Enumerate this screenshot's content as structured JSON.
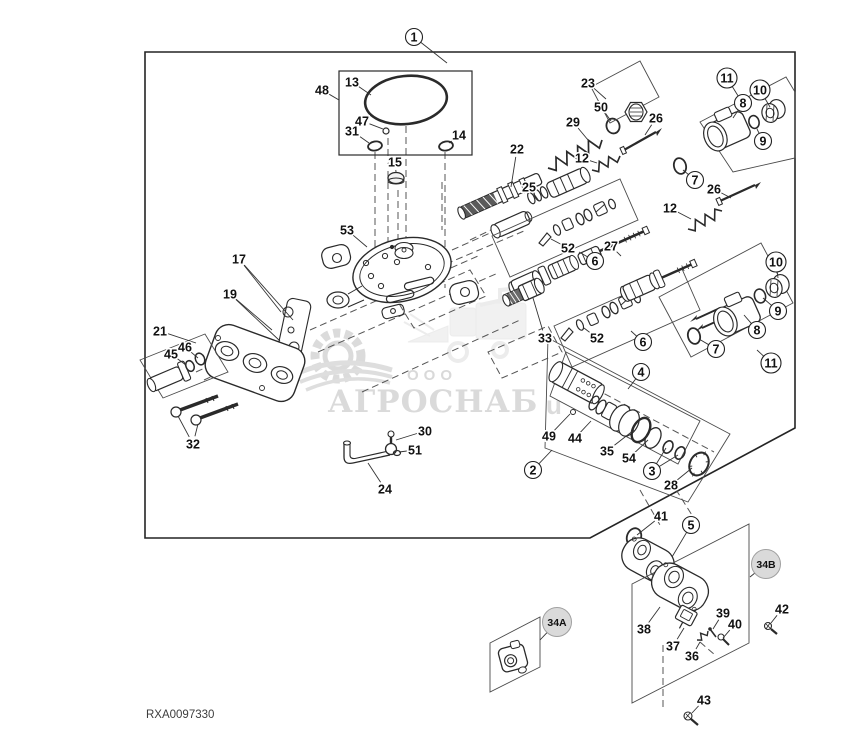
{
  "footer": {
    "part_number": "RXA0097330"
  },
  "watermark": {
    "prefix": "ООО",
    "company": "АГРОСНАБ",
    "fragment": "u",
    "color": "#c6c6c6"
  },
  "diagram": {
    "line_color": "#2a2a2a",
    "box_color": "#4a4a4a"
  },
  "callouts": [
    {
      "label": "1",
      "x": 414,
      "y": 37,
      "style": "circled",
      "leaders": [
        [
          447,
          63
        ]
      ]
    },
    {
      "label": "13",
      "x": 352,
      "y": 82,
      "style": "plain",
      "leaders": [
        [
          371,
          95
        ]
      ]
    },
    {
      "label": "48",
      "x": 322,
      "y": 90,
      "style": "plain",
      "leaders": [
        [
          339,
          100
        ]
      ]
    },
    {
      "label": "47",
      "x": 362,
      "y": 121,
      "style": "plain",
      "leaders": [
        [
          383,
          129
        ]
      ]
    },
    {
      "label": "31",
      "x": 352,
      "y": 131,
      "style": "plain",
      "leaders": [
        [
          369,
          143
        ]
      ]
    },
    {
      "label": "14",
      "x": 459,
      "y": 135,
      "style": "plain",
      "leaders": [
        [
          449,
          143
        ]
      ]
    },
    {
      "label": "15",
      "x": 395,
      "y": 162,
      "style": "plain",
      "leaders": [
        [
          396,
          172
        ]
      ]
    },
    {
      "label": "53",
      "x": 347,
      "y": 230,
      "style": "plain",
      "leaders": [
        [
          367,
          247
        ]
      ]
    },
    {
      "label": "17",
      "x": 239,
      "y": 259,
      "style": "plain",
      "leaders": [
        [
          281,
          312
        ],
        [
          293,
          320
        ]
      ]
    },
    {
      "label": "19",
      "x": 230,
      "y": 294,
      "style": "plain",
      "leaders": [
        [
          272,
          330
        ],
        [
          280,
          341
        ]
      ]
    },
    {
      "label": "21",
      "x": 160,
      "y": 331,
      "style": "plain",
      "leaders": [
        [
          196,
          343
        ]
      ]
    },
    {
      "label": "45",
      "x": 171,
      "y": 354,
      "style": "plain",
      "leaders": [
        [
          186,
          365
        ]
      ]
    },
    {
      "label": "46",
      "x": 185,
      "y": 347,
      "style": "plain",
      "leaders": [
        [
          198,
          358
        ]
      ]
    },
    {
      "label": "32",
      "x": 193,
      "y": 444,
      "style": "plain",
      "leaders": [
        [
          178,
          416
        ],
        [
          198,
          424
        ]
      ]
    },
    {
      "label": "30",
      "x": 425,
      "y": 431,
      "style": "plain",
      "leaders": [
        [
          396,
          440
        ]
      ]
    },
    {
      "label": "51",
      "x": 415,
      "y": 450,
      "style": "plain",
      "leaders": [
        [
          399,
          452
        ]
      ]
    },
    {
      "label": "24",
      "x": 385,
      "y": 489,
      "style": "plain",
      "leaders": [
        [
          368,
          463
        ]
      ]
    },
    {
      "label": "22",
      "x": 517,
      "y": 149,
      "style": "plain",
      "leaders": [
        [
          511,
          187
        ]
      ]
    },
    {
      "label": "29",
      "x": 573,
      "y": 122,
      "style": "plain",
      "leaders": [
        [
          588,
          140
        ]
      ]
    },
    {
      "label": "23",
      "x": 588,
      "y": 83,
      "style": "plain",
      "leaders": [
        [
          606,
          99
        ]
      ]
    },
    {
      "label": "50",
      "x": 601,
      "y": 107,
      "style": "plain",
      "leaders": [
        [
          611,
          121
        ]
      ]
    },
    {
      "label": "26",
      "x": 656,
      "y": 118,
      "style": "plain",
      "leaders": [
        [
          645,
          135
        ]
      ]
    },
    {
      "label": "12",
      "x": 582,
      "y": 158,
      "style": "plain",
      "leaders": [
        [
          597,
          163
        ]
      ]
    },
    {
      "label": "25",
      "x": 529,
      "y": 187,
      "style": "plain",
      "leaders": [
        [
          539,
          201
        ]
      ]
    },
    {
      "label": "27",
      "x": 611,
      "y": 246,
      "style": "plain",
      "leaders": [
        [
          621,
          256
        ]
      ]
    },
    {
      "label": "52",
      "x": 568,
      "y": 248,
      "style": "plain",
      "leaders": [
        [
          551,
          239
        ]
      ]
    },
    {
      "label": "6",
      "x": 595,
      "y": 261,
      "style": "circled",
      "leaders": [
        [
          579,
          252
        ]
      ]
    },
    {
      "label": "11",
      "x": 727,
      "y": 78,
      "style": "circled",
      "leaders": [
        [
          740,
          99
        ]
      ]
    },
    {
      "label": "10",
      "x": 760,
      "y": 90,
      "style": "circled",
      "leaders": [
        [
          770,
          107
        ]
      ]
    },
    {
      "label": "8",
      "x": 743,
      "y": 103,
      "style": "circled",
      "leaders": [
        [
          733,
          118
        ]
      ]
    },
    {
      "label": "9",
      "x": 763,
      "y": 141,
      "style": "circled",
      "leaders": [
        [
          757,
          129
        ]
      ]
    },
    {
      "label": "7",
      "x": 695,
      "y": 180,
      "style": "circled",
      "leaders": [
        [
          683,
          170
        ]
      ]
    },
    {
      "label": "26",
      "x": 714,
      "y": 189,
      "style": "plain",
      "leaders": [
        [
          731,
          198
        ]
      ]
    },
    {
      "label": "12",
      "x": 670,
      "y": 208,
      "style": "plain",
      "leaders": [
        [
          691,
          219
        ]
      ]
    },
    {
      "label": "33",
      "x": 545,
      "y": 338,
      "style": "plain",
      "leaders": [
        [
          533,
          298
        ]
      ]
    },
    {
      "label": "52",
      "x": 597,
      "y": 338,
      "style": "plain",
      "leaders": [
        [
          584,
          328
        ]
      ]
    },
    {
      "label": "6",
      "x": 643,
      "y": 342,
      "style": "circled",
      "leaders": [
        [
          631,
          331
        ]
      ]
    },
    {
      "label": "7",
      "x": 716,
      "y": 349,
      "style": "circled",
      "leaders": [
        [
          699,
          339
        ]
      ]
    },
    {
      "label": "8",
      "x": 757,
      "y": 330,
      "style": "circled",
      "leaders": [
        [
          744,
          315
        ]
      ]
    },
    {
      "label": "11",
      "x": 771,
      "y": 363,
      "style": "circled",
      "leaders": [
        [
          757,
          350
        ]
      ]
    },
    {
      "label": "10",
      "x": 776,
      "y": 262,
      "style": "circled",
      "leaders": [
        [
          778,
          278
        ]
      ]
    },
    {
      "label": "9",
      "x": 778,
      "y": 311,
      "style": "circled",
      "leaders": [
        [
          763,
          298
        ]
      ]
    },
    {
      "label": "4",
      "x": 641,
      "y": 372,
      "style": "circled",
      "leaders": [
        [
          628,
          389
        ]
      ]
    },
    {
      "label": "2",
      "x": 533,
      "y": 470,
      "style": "circled",
      "leaders": [
        [
          552,
          450
        ]
      ]
    },
    {
      "label": "49",
      "x": 549,
      "y": 436,
      "style": "plain",
      "leaders": [
        [
          570,
          414
        ]
      ]
    },
    {
      "label": "44",
      "x": 575,
      "y": 438,
      "style": "plain",
      "leaders": [
        [
          591,
          421
        ]
      ]
    },
    {
      "label": "35",
      "x": 607,
      "y": 451,
      "style": "plain",
      "leaders": [
        [
          634,
          430
        ]
      ]
    },
    {
      "label": "54",
      "x": 629,
      "y": 458,
      "style": "plain",
      "leaders": [
        [
          648,
          440
        ]
      ]
    },
    {
      "label": "3",
      "x": 652,
      "y": 471,
      "style": "circled",
      "leaders": [
        [
          666,
          448
        ],
        [
          678,
          455
        ]
      ]
    },
    {
      "label": "28",
      "x": 671,
      "y": 485,
      "style": "plain",
      "leaders": [
        [
          692,
          468
        ]
      ]
    },
    {
      "label": "41",
      "x": 661,
      "y": 516,
      "style": "plain",
      "leaders": [
        [
          637,
          535
        ]
      ]
    },
    {
      "label": "5",
      "x": 691,
      "y": 525,
      "style": "circled",
      "leaders": [
        [
          672,
          557
        ]
      ]
    },
    {
      "label": "34B",
      "x": 766,
      "y": 564,
      "style": "badge",
      "leaders": [
        [
          750,
          577
        ]
      ]
    },
    {
      "label": "38",
      "x": 644,
      "y": 629,
      "style": "plain",
      "leaders": [
        [
          660,
          607
        ]
      ]
    },
    {
      "label": "37",
      "x": 673,
      "y": 646,
      "style": "plain",
      "leaders": [
        [
          684,
          628
        ]
      ]
    },
    {
      "label": "36",
      "x": 692,
      "y": 656,
      "style": "plain",
      "leaders": [
        [
          700,
          642
        ]
      ]
    },
    {
      "label": "39",
      "x": 723,
      "y": 613,
      "style": "plain",
      "leaders": [
        [
          713,
          629
        ]
      ]
    },
    {
      "label": "40",
      "x": 735,
      "y": 624,
      "style": "plain",
      "leaders": [
        [
          723,
          638
        ]
      ]
    },
    {
      "label": "42",
      "x": 782,
      "y": 609,
      "style": "plain",
      "leaders": [
        [
          771,
          623
        ]
      ]
    },
    {
      "label": "43",
      "x": 704,
      "y": 700,
      "style": "plain",
      "leaders": [
        [
          692,
          713
        ]
      ]
    },
    {
      "label": "34A",
      "x": 557,
      "y": 622,
      "style": "badge",
      "leaders": [
        [
          540,
          640
        ]
      ]
    }
  ]
}
